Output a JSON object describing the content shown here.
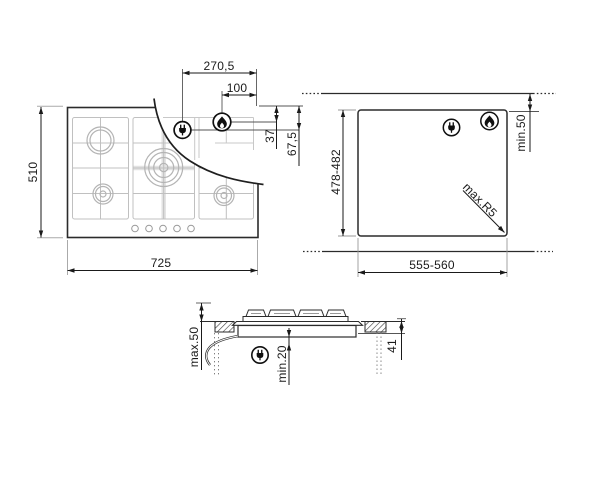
{
  "top_view": {
    "dim_width": "725",
    "dim_depth": "510",
    "dim_plug_from_right": "270,5",
    "dim_gas_from_right": "100",
    "dim_gas_from_top": "37",
    "dim_plug_from_top": "67,5",
    "icons": {
      "electrical": "plug-icon",
      "gas": "flame-icon"
    }
  },
  "cutout_view": {
    "dim_cutout_width": "555-560",
    "dim_cutout_depth": "478-482",
    "dim_rear_clearance": "min.50",
    "dim_corner_radius": "max.R5",
    "icons": {
      "electrical": "plug-icon",
      "gas": "flame-icon"
    }
  },
  "side_view": {
    "dim_height_above": "max.50",
    "dim_clearance_below": "min.20",
    "dim_depth_below_worktop": "41",
    "icons": {
      "electrical": "plug-icon"
    }
  },
  "colors": {
    "line": "#2b2b2b",
    "dim": "#1a1a1a",
    "grid_gray": "#c0c0c0",
    "burner_gray": "#b4b4b4",
    "background": "#ffffff"
  }
}
